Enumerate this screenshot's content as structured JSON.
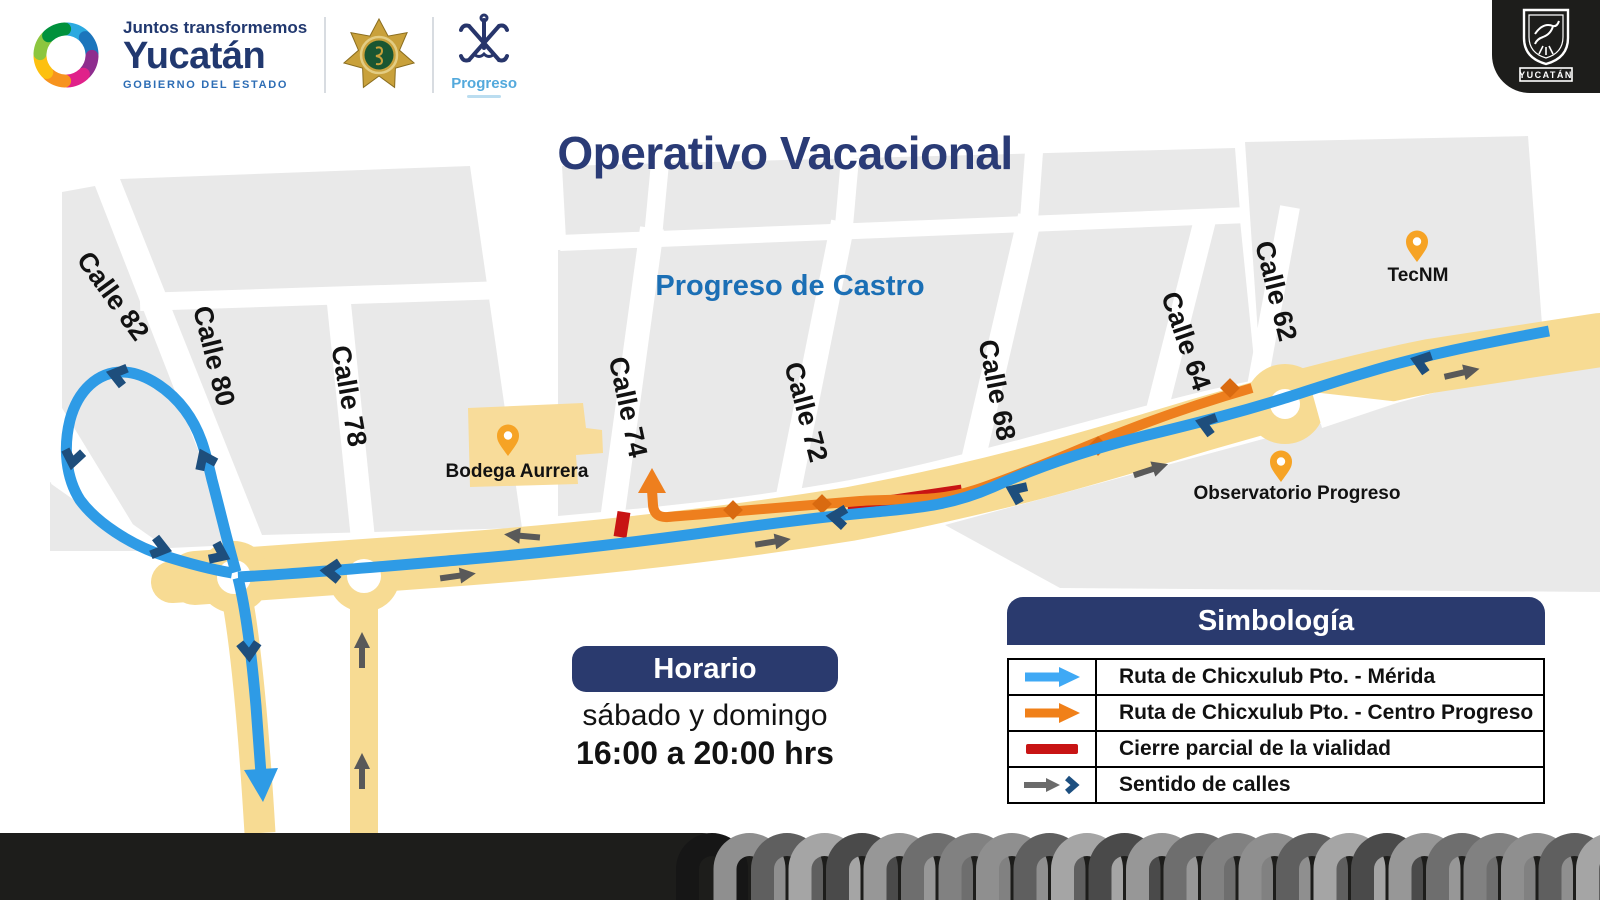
{
  "header": {
    "tagline": "Juntos transformemos",
    "state_name": "Yucatán",
    "state_sub": "GOBIERNO DEL ESTADO",
    "progreso_label": "Progreso",
    "corner_badge_label": "YUCATÁN"
  },
  "title": "Operativo Vacacional",
  "map": {
    "area_label": "Progreso de Castro",
    "street_labels": [
      "Calle 82",
      "Calle 80",
      "Calle 78",
      "Calle 74",
      "Calle 72",
      "Calle 68",
      "Calle 64",
      "Calle 62"
    ],
    "pois": {
      "bodega": "Bodega Aurrera",
      "tecnm": "TecNM",
      "observatorio": "Observatorio Progreso"
    }
  },
  "schedule": {
    "heading": "Horario",
    "days": "sábado y domingo",
    "hours": "16:00 a 20:00 hrs"
  },
  "legend": {
    "title": "Simbología",
    "items": [
      {
        "symbol": "blue-arrow",
        "label": "Ruta de Chicxulub Pto. - Mérida"
      },
      {
        "symbol": "orange-arrow",
        "label": "Ruta de Chicxulub Pto. - Centro Progreso"
      },
      {
        "symbol": "red-bar",
        "label": "Cierre parcial de la vialidad"
      },
      {
        "symbol": "gray-arrow-blue-chevron",
        "label": "Sentido de calles"
      }
    ]
  },
  "colors": {
    "route_merida_blue": "#2E9BE6",
    "route_centro_orange": "#EE7F1E",
    "closure_red": "#C81414",
    "road_yellow": "#F7DB93",
    "block_gray": "#E9E9E9",
    "navy": "#2A3A6E",
    "area_label_blue": "#1B6FB5",
    "pin_orange": "#F6A325",
    "direction_gray": "#595959",
    "chevron_navy": "#1E4E7C",
    "footer_dark": "#1D1D1B"
  }
}
